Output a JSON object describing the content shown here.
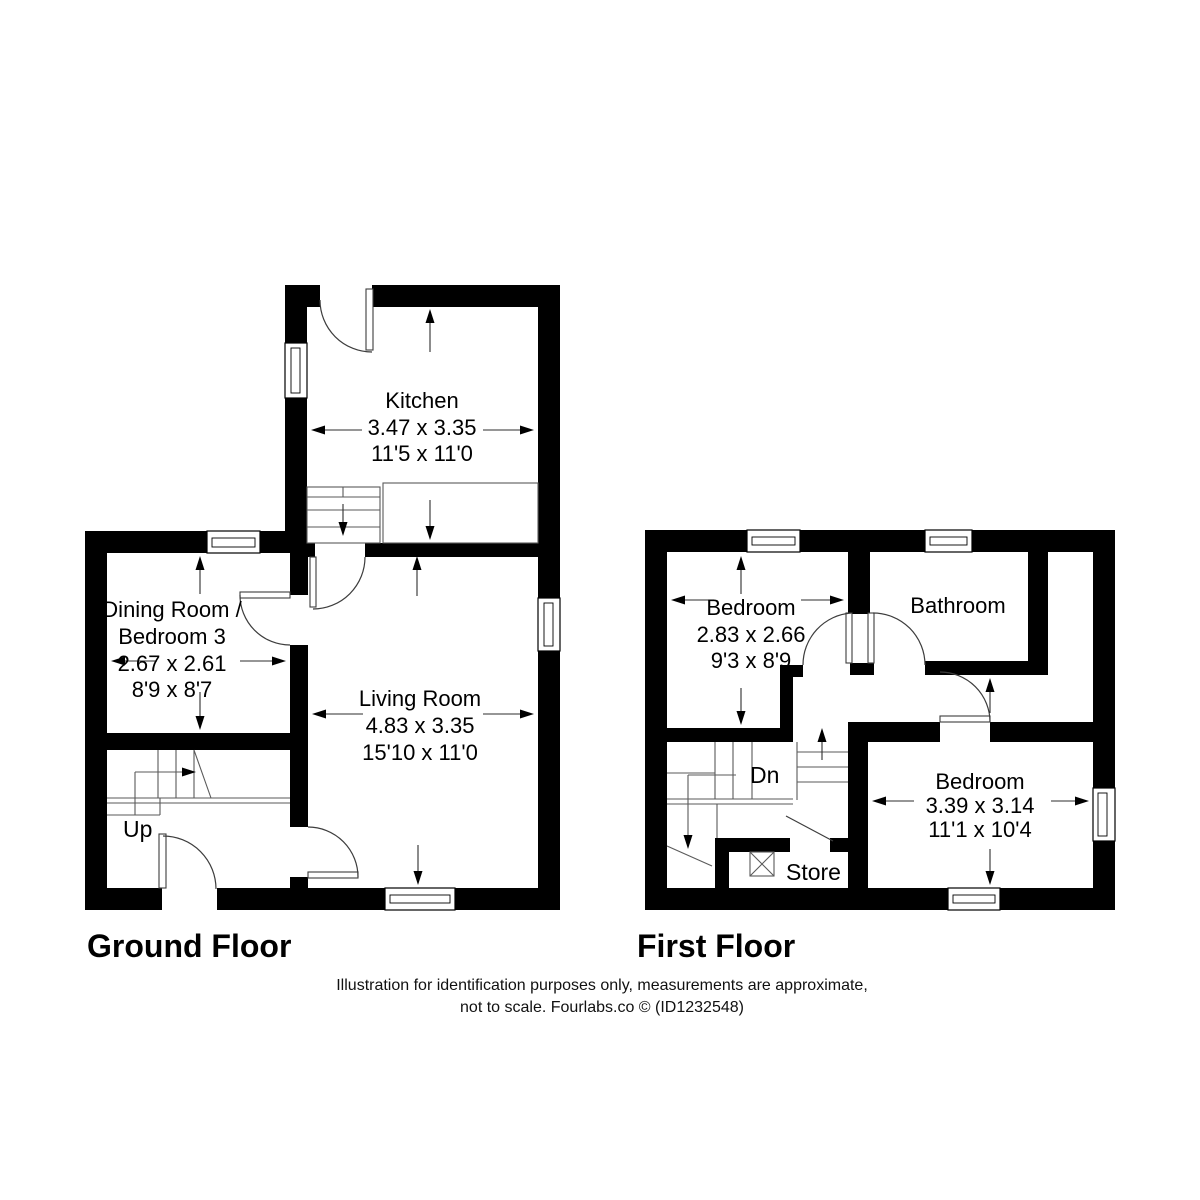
{
  "ground_floor": {
    "title": "Ground Floor",
    "stairs_label": "Up",
    "kitchen": {
      "name": "Kitchen",
      "metric": "3.47 x 3.35",
      "imperial": "11'5 x 11'0"
    },
    "dining": {
      "name_line1": "Dining Room /",
      "name_line2": "Bedroom 3",
      "metric": "2.67 x 2.61",
      "imperial": "8'9 x 8'7"
    },
    "living": {
      "name": "Living Room",
      "metric": "4.83 x 3.35",
      "imperial": "15'10 x 11'0"
    }
  },
  "first_floor": {
    "title": "First Floor",
    "stairs_label": "Dn",
    "bedroom_1": {
      "name": "Bedroom",
      "metric": "2.83 x 2.66",
      "imperial": "9'3 x 8'9"
    },
    "bathroom": {
      "name": "Bathroom"
    },
    "bedroom_2": {
      "name": "Bedroom",
      "metric": "3.39 x 3.14",
      "imperial": "11'1 x 10'4"
    },
    "store": {
      "name": "Store"
    }
  },
  "disclaimer": {
    "line1": "Illustration for identification purposes only, measurements are approximate,",
    "line2": "not to scale. Fourlabs.co © (ID1232548)"
  },
  "colors": {
    "wall": "#000000",
    "background": "#ffffff",
    "thin_line": "#5a5a5a"
  }
}
